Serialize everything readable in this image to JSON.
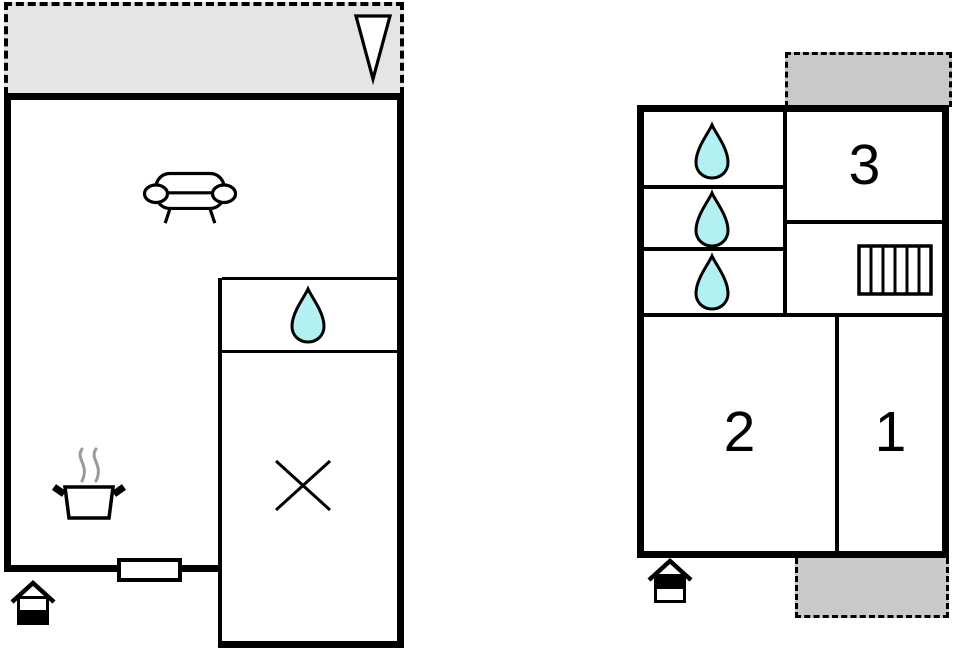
{
  "document": {
    "type": "floor-plan",
    "units": 2
  },
  "colors": {
    "wall": "#000000",
    "terrace_fill": "#e5e5e5",
    "balcony_fill": "#c9c9c9",
    "water_drop_fill": "#b2f0f2",
    "steam": "#9a9a9a",
    "icon_fill": "#ffffff"
  },
  "left_unit": {
    "icons": {
      "entrance_arrow": "entrance-arrow-icon",
      "sofa": "sofa-icon",
      "water_drop": "water-drop-icon",
      "shower": "shower-x-icon",
      "stove": "stove-pot-icon",
      "entrance": "entrance-house-icon"
    }
  },
  "right_unit": {
    "rooms": [
      {
        "id": "room-3",
        "label": "3"
      },
      {
        "id": "room-2",
        "label": "2"
      },
      {
        "id": "room-1",
        "label": "1"
      }
    ],
    "water_drops": 3,
    "icons": {
      "radiator": "radiator-icon",
      "entrance": "entrance-house-icon"
    }
  }
}
